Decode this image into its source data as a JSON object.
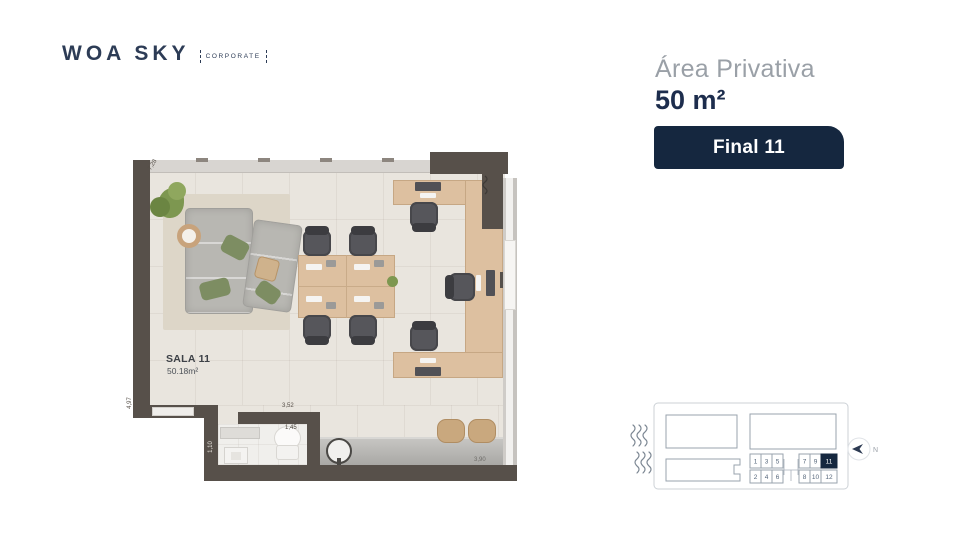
{
  "brand": {
    "name": "WOA SKY",
    "tag": "CORPORATE"
  },
  "info": {
    "area_label": "Área Privativa",
    "area_value": "50 m²",
    "unit_badge": "Final 11"
  },
  "plan": {
    "room_name": "SALA 11",
    "room_area": "50.18m²",
    "dims": {
      "left_wall": "4,97",
      "top_wall": "7,28",
      "hall_width": "3,52",
      "bath_width": "1,45",
      "bath_depth": "1,10",
      "counter_width": "3,90"
    }
  },
  "keyplan": {
    "row1": [
      "1",
      "3",
      "5",
      "7",
      "9",
      "11"
    ],
    "row2": [
      "2",
      "4",
      "6",
      "8",
      "10",
      "12"
    ],
    "highlighted_unit": "11",
    "north_label": "N"
  },
  "colors": {
    "navy": "#15273f",
    "text_gray": "#9aa0a7",
    "wall": "#57504a",
    "wood": "#ddc0a0",
    "floor": "#e9e5de"
  }
}
